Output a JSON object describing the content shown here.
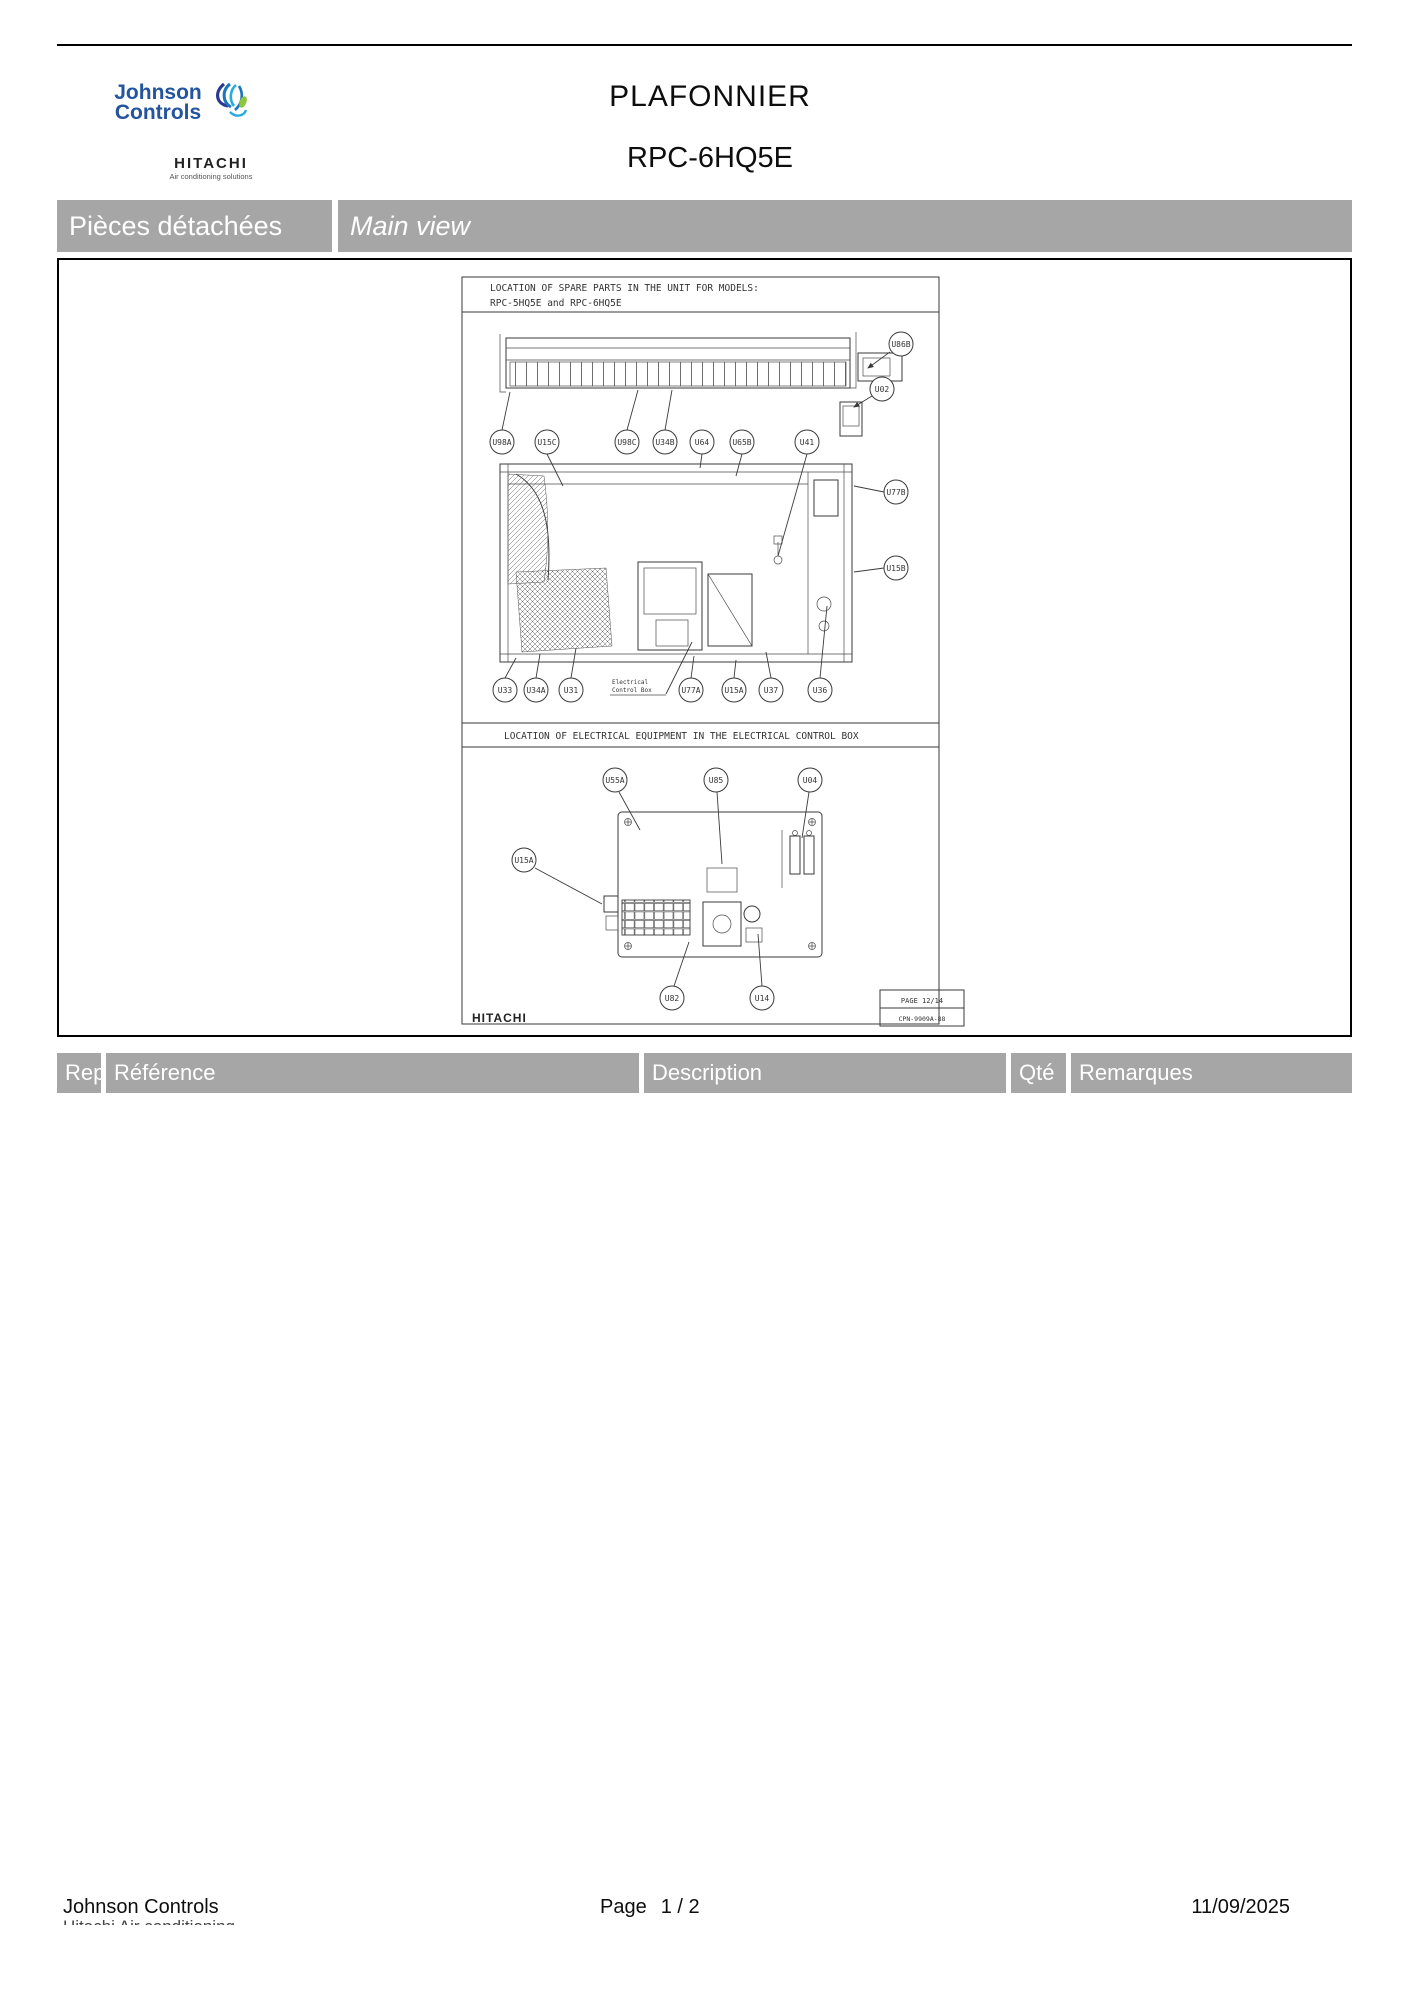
{
  "colors": {
    "banner_gray": "#a6a6a6",
    "brand_blue": "#23549c"
  },
  "header": {
    "title": "PLAFONNIER",
    "subtitle": "RPC-6HQ5E",
    "logo": {
      "line1": "Johnson",
      "line2": "Controls",
      "brand": "HITACHI",
      "brand_tagline": "Air conditioning solutions"
    }
  },
  "banner": {
    "section": "Pièces détachées",
    "view": "Main view"
  },
  "drawing": {
    "spare_parts": {
      "title_line1": "LOCATION OF SPARE PARTS IN THE UNIT FOR MODELS:",
      "title_line2": "RPC-5HQ5E and RPC-6HQ5E",
      "callouts": {
        "top_right": [
          "U86B",
          "U02"
        ],
        "row1": [
          "U98A",
          "U15C",
          "U98C",
          "U34B",
          "U64",
          "U65B",
          "U41"
        ],
        "right": [
          "U77B",
          "U15B"
        ],
        "bottom": [
          "U33",
          "U34A",
          "U31",
          "U77A",
          "U15A",
          "U37",
          "U36"
        ]
      },
      "note_line1": "Electrical",
      "note_line2": "Control Box"
    },
    "electrical_box": {
      "title": "LOCATION OF ELECTRICAL EQUIPMENT IN THE ELECTRICAL CONTROL BOX",
      "callouts": {
        "top": [
          "U55A",
          "U85",
          "U04"
        ],
        "left": "U15A",
        "bottom": [
          "U82",
          "U14"
        ]
      }
    },
    "brand": "HITACHI",
    "page_ref_line1": "PAGE 12/14",
    "page_ref_line2": "CPN-9909A-88"
  },
  "table": {
    "headers": [
      "Rep.",
      "Référence",
      "Description",
      "Qté",
      "Remarques"
    ]
  },
  "footer": {
    "company": "Johnson Controls",
    "company_line2_partial": "Hitachi Air conditioning",
    "page_label": "Page",
    "page_value": "1 / 2",
    "date": "11/09/2025"
  }
}
